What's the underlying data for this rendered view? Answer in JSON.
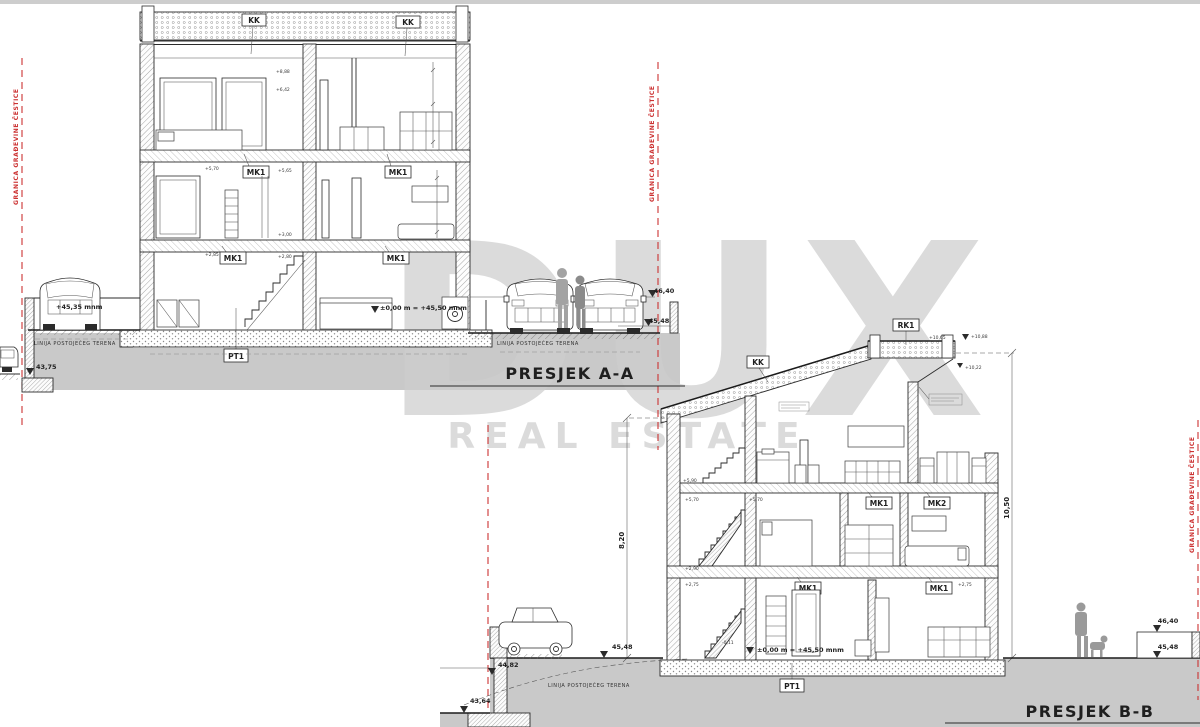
{
  "watermark": {
    "line1": "DUX",
    "line2": "REAL ESTATE"
  },
  "boundary": {
    "label": "GRANICA GRAĐEVINE ČESTICE"
  },
  "terrain": {
    "label": "LINIJA POSTOJEĆEG TERENA"
  },
  "colors": {
    "boundary_red": "#cc3333",
    "terrain_gray": "#c9c9c9",
    "watermark_gray": "#cdcdcd"
  },
  "section_a": {
    "title": "PRESJEK A-A",
    "tags": {
      "kk": "KK",
      "mk1": "MK1",
      "pt1": "PT1"
    },
    "elevations": {
      "terrain_left": "43,75",
      "car_platform": "+45,35 mnm",
      "street_upper": "46,40",
      "street_lower": "45,48",
      "zero_line": "±0,00 m = +45,50 mnm"
    },
    "micro_levels": {
      "l1": "+8,88",
      "l2": "+6,42",
      "l3": "+5,70",
      "l4": "+5,65",
      "l5": "+3,00",
      "l6": "+2,85",
      "l7": "+2,80"
    }
  },
  "section_b": {
    "title": "PRESJEK B-B",
    "tags": {
      "rk1": "RK1",
      "kk": "KK",
      "mk1": "MK1",
      "mk2": "MK2",
      "pt1": "PT1"
    },
    "dimensions": {
      "height_left": "8,20",
      "height_right": "10,50"
    },
    "elevations": {
      "roof_left": "+10,65",
      "roof_peak": "+10,88",
      "roof_eave": "+10,22",
      "street_left": "45,48",
      "wall_top_left": "44,82",
      "terrain_left": "43,64",
      "street_upper_right": "46,40",
      "street_lower_right": "45,48",
      "zero_line": "±0,00 m = +45,50 mnm"
    },
    "micro_levels": {
      "l1": "+5,90",
      "l2": "+5,70",
      "l3": "+5,70",
      "l4": "+2,90",
      "l5": "+2,75",
      "l6": "+2,75",
      "l7": "-0,11"
    }
  }
}
